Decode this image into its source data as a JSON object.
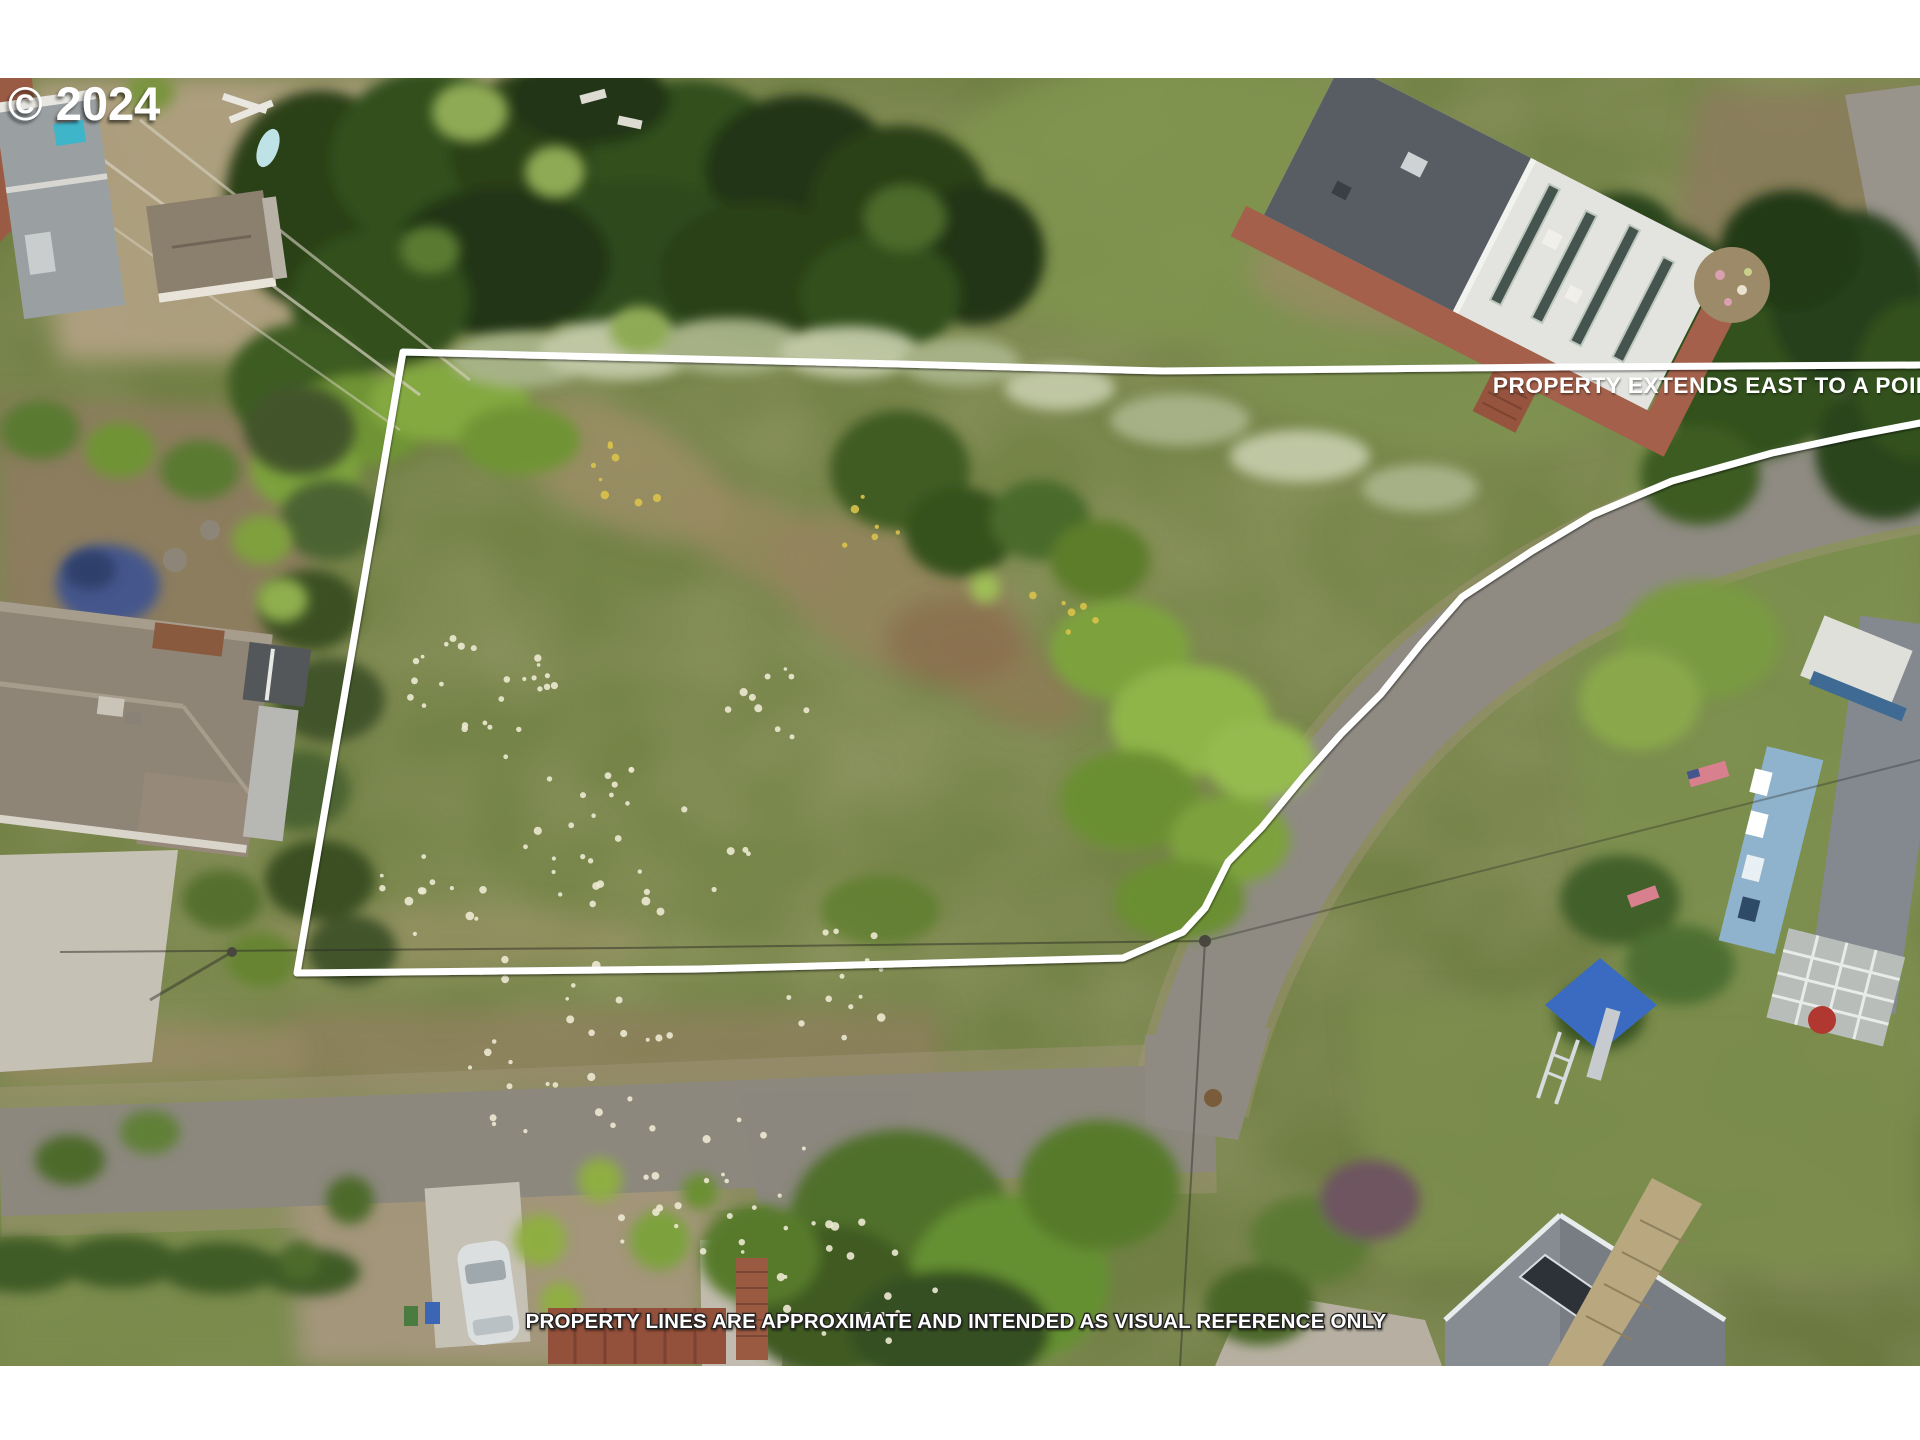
{
  "overlay": {
    "copyright": "© 2024",
    "extends_east_label": "PROPERTY EXTENDS EAST TO A POINT",
    "disclaimer": "PROPERTY LINES ARE APPROXIMATE AND INTENDED AS VISUAL REFERENCE ONLY",
    "property_line": {
      "color": "#ffffff",
      "width": 7,
      "points": [
        [
          1920,
          365
        ],
        [
          1560,
          367
        ],
        [
          1163,
          371
        ],
        [
          900,
          364
        ],
        [
          403,
          352
        ],
        [
          297,
          973
        ],
        [
          700,
          969
        ],
        [
          1123,
          958
        ],
        [
          1183,
          932
        ],
        [
          1205,
          908
        ],
        [
          1228,
          862
        ],
        [
          1262,
          827
        ],
        [
          1303,
          777
        ],
        [
          1341,
          734
        ],
        [
          1381,
          694
        ],
        [
          1421,
          644
        ],
        [
          1462,
          597
        ],
        [
          1532,
          551
        ],
        [
          1592,
          515
        ],
        [
          1672,
          481
        ],
        [
          1772,
          453
        ],
        [
          1852,
          436
        ],
        [
          1920,
          423
        ]
      ]
    }
  },
  "scene": {
    "colors": {
      "letterbox": "#ffffff",
      "watermark_text": "#ffffff",
      "annotation_text": "#ffffff",
      "meadow": "#728044",
      "forest": "#2d4719",
      "asphalt": "#8f8b83",
      "gravel_shoulder": "#a2947a",
      "concrete": "#c6c1b5",
      "deck_red": "#a4604a",
      "roof_dark_gray": "#585d63",
      "roof_white": "#e3e4df",
      "house_blue": "#8fb3cc",
      "play_tarp_blue": "#3a6bc0",
      "garden_blue_patch": "#44568c",
      "wildflower_white": "#ece9d2",
      "wildflower_yellow": "#d9c24a"
    },
    "wildflower_clusters": [
      {
        "cx": 500,
        "cy": 690,
        "r": 95,
        "n": 26,
        "color": "#ece9d2"
      },
      {
        "cx": 640,
        "cy": 830,
        "r": 120,
        "n": 30,
        "color": "#ece9d2"
      },
      {
        "cx": 560,
        "cy": 1040,
        "r": 130,
        "n": 26,
        "color": "#ece9d2"
      },
      {
        "cx": 700,
        "cy": 1180,
        "r": 120,
        "n": 24,
        "color": "#ece9d2"
      },
      {
        "cx": 860,
        "cy": 1280,
        "r": 90,
        "n": 18,
        "color": "#ece9d2"
      },
      {
        "cx": 830,
        "cy": 980,
        "r": 80,
        "n": 14,
        "color": "#ece9d2"
      },
      {
        "cx": 760,
        "cy": 700,
        "r": 60,
        "n": 10,
        "color": "#ece9d2"
      },
      {
        "cx": 430,
        "cy": 900,
        "r": 60,
        "n": 12,
        "color": "#ece9d2"
      },
      {
        "cx": 640,
        "cy": 470,
        "r": 55,
        "n": 8,
        "color": "#d9c24a"
      },
      {
        "cx": 870,
        "cy": 520,
        "r": 45,
        "n": 6,
        "color": "#d9c24a"
      },
      {
        "cx": 1060,
        "cy": 615,
        "r": 40,
        "n": 6,
        "color": "#d9c24a"
      }
    ]
  }
}
